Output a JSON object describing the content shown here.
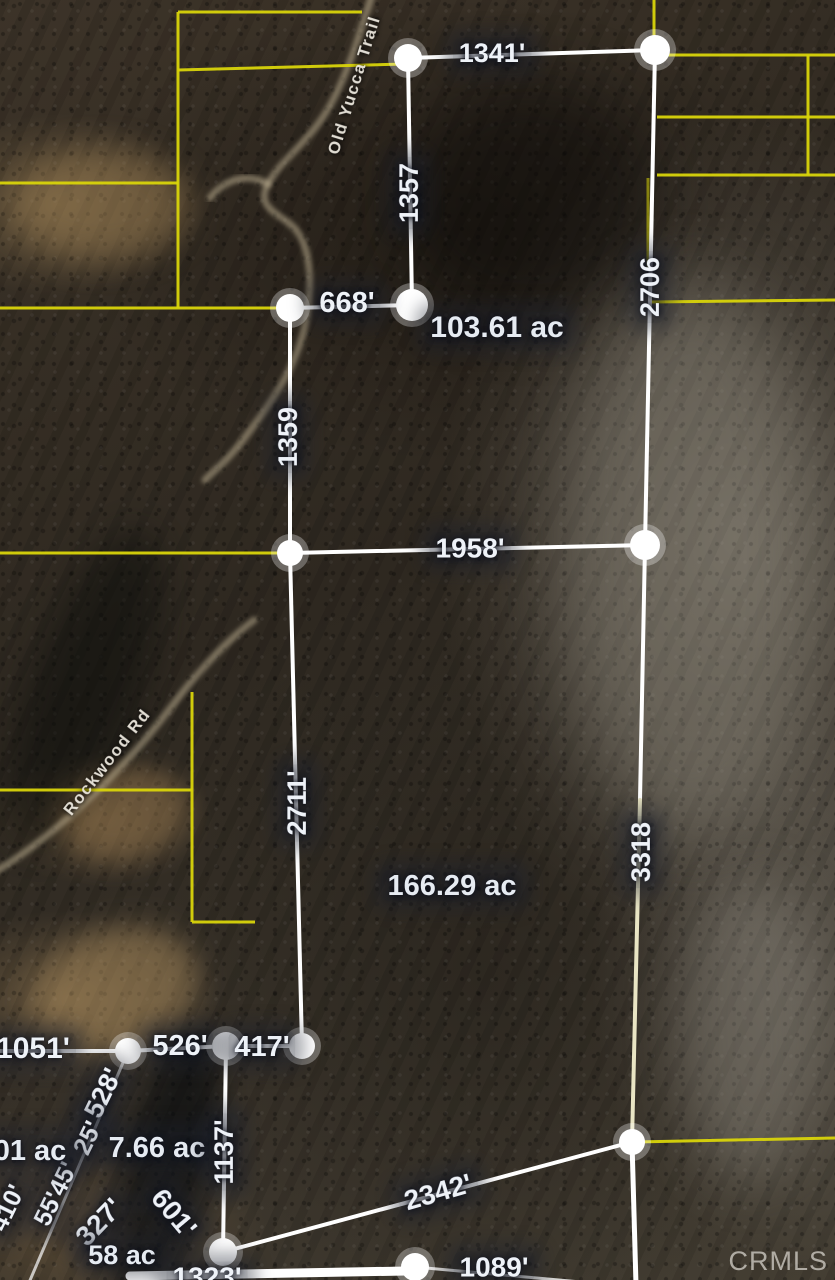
{
  "watermark": "CRMLS",
  "colors": {
    "boundary_white": "#ffffff",
    "boundary_cream": "#e9e5c4",
    "parcel_yellow": "#d9d40a",
    "label_text": "#eef2f8"
  },
  "parcels": [
    {
      "acreage_label": "103.61 ac",
      "side_labels": [
        "1341'",
        "1357",
        "668'",
        "1359",
        "1958'",
        "2706"
      ]
    },
    {
      "acreage_label": "166.29 ac",
      "side_labels": [
        "1958'",
        "2711'",
        "417'",
        "1137'",
        "2342'",
        "3318"
      ]
    }
  ],
  "roads_named": [
    "Old Yucca Trail",
    "Rockwood Rd"
  ],
  "overlay": {
    "labels": [
      {
        "name": "dim-1341",
        "text": "1341'",
        "x": 492,
        "y": 53,
        "rot": 0,
        "fs": 27,
        "cls": "dim"
      },
      {
        "name": "dim-1357",
        "text": "1357",
        "x": 409,
        "y": 193,
        "rot": -90,
        "fs": 27,
        "cls": "dim"
      },
      {
        "name": "dim-668",
        "text": "668'",
        "x": 347,
        "y": 303,
        "rot": 0,
        "fs": 29,
        "cls": "dim"
      },
      {
        "name": "acreage-103-61",
        "text": "103.61 ac",
        "x": 497,
        "y": 328,
        "rot": 0,
        "fs": 30,
        "cls": "ac"
      },
      {
        "name": "dim-2706",
        "text": "2706",
        "x": 650,
        "y": 287,
        "rot": -90,
        "fs": 27,
        "cls": "dim"
      },
      {
        "name": "dim-1359",
        "text": "1359",
        "x": 288,
        "y": 437,
        "rot": -90,
        "fs": 27,
        "cls": "dim"
      },
      {
        "name": "dim-1958",
        "text": "1958'",
        "x": 470,
        "y": 548,
        "rot": 0,
        "fs": 28,
        "cls": "dim"
      },
      {
        "name": "dim-2711",
        "text": "2711'",
        "x": 297,
        "y": 803,
        "rot": -90,
        "fs": 27,
        "cls": "dim"
      },
      {
        "name": "acreage-166-29",
        "text": "166.29 ac",
        "x": 452,
        "y": 886,
        "rot": 0,
        "fs": 29,
        "cls": "ac"
      },
      {
        "name": "dim-3318",
        "text": "3318",
        "x": 641,
        "y": 852,
        "rot": -90,
        "fs": 27,
        "cls": "dim"
      },
      {
        "name": "dim-1051",
        "text": "1051'",
        "x": 33,
        "y": 1049,
        "rot": 0,
        "fs": 30,
        "cls": "dim"
      },
      {
        "name": "dim-526",
        "text": "526'",
        "x": 180,
        "y": 1046,
        "rot": 0,
        "fs": 29,
        "cls": "dim"
      },
      {
        "name": "dim-417",
        "text": "417'",
        "x": 262,
        "y": 1047,
        "rot": 0,
        "fs": 29,
        "cls": "dim"
      },
      {
        "name": "dim-528",
        "text": "528'",
        "x": 103,
        "y": 1093,
        "rot": -64,
        "fs": 27,
        "cls": "dim"
      },
      {
        "name": "dim-25",
        "text": "25'",
        "x": 88,
        "y": 1138,
        "rot": -64,
        "fs": 25,
        "cls": "dim"
      },
      {
        "name": "dim-55-45",
        "text": "55'45'",
        "x": 56,
        "y": 1194,
        "rot": -64,
        "fs": 25,
        "cls": "dim"
      },
      {
        "name": "dim-410",
        "text": "410'",
        "x": 8,
        "y": 1208,
        "rot": -64,
        "fs": 25,
        "cls": "dim"
      },
      {
        "name": "acreage-01",
        "text": "01 ac",
        "x": 30,
        "y": 1151,
        "rot": 0,
        "fs": 29,
        "cls": "ac"
      },
      {
        "name": "acreage-7-66",
        "text": "7.66 ac",
        "x": 157,
        "y": 1148,
        "rot": 0,
        "fs": 29,
        "cls": "ac"
      },
      {
        "name": "dim-1137",
        "text": "1137'",
        "x": 224,
        "y": 1152,
        "rot": -90,
        "fs": 27,
        "cls": "dim"
      },
      {
        "name": "dim-327",
        "text": "327'",
        "x": 99,
        "y": 1222,
        "rot": -46,
        "fs": 28,
        "cls": "dim"
      },
      {
        "name": "dim-601",
        "text": "601'",
        "x": 174,
        "y": 1213,
        "rot": 50,
        "fs": 28,
        "cls": "dim"
      },
      {
        "name": "acreage-58",
        "text": "58 ac",
        "x": 122,
        "y": 1255,
        "rot": 0,
        "fs": 27,
        "cls": "ac"
      },
      {
        "name": "dim-1323",
        "text": "1323'",
        "x": 207,
        "y": 1277,
        "rot": 0,
        "fs": 28,
        "cls": "dim"
      },
      {
        "name": "dim-2342",
        "text": "2342'",
        "x": 438,
        "y": 1192,
        "rot": -16,
        "fs": 28,
        "cls": "dim"
      },
      {
        "name": "dim-1089",
        "text": "1089'",
        "x": 494,
        "y": 1267,
        "rot": 0,
        "fs": 28,
        "cls": "dim"
      },
      {
        "name": "road-old-yucca-trail",
        "text": "Old Yucca Trail",
        "x": 354,
        "y": 85,
        "rot": -73,
        "fs": 17,
        "cls": "road"
      },
      {
        "name": "road-rockwood-rd",
        "text": "Rockwood Rd",
        "x": 107,
        "y": 762,
        "rot": -52,
        "fs": 17,
        "cls": "road"
      }
    ],
    "white_lines": [
      {
        "x1": 408,
        "y1": 58,
        "x2": 655,
        "y2": 50
      },
      {
        "x1": 408,
        "y1": 58,
        "x2": 412,
        "y2": 305
      },
      {
        "x1": 290,
        "y1": 308,
        "x2": 412,
        "y2": 305
      },
      {
        "x1": 655,
        "y1": 50,
        "x2": 645,
        "y2": 545
      },
      {
        "x1": 290,
        "y1": 308,
        "x2": 290,
        "y2": 553
      },
      {
        "x1": 290,
        "y1": 553,
        "x2": 645,
        "y2": 545
      },
      {
        "x1": 290,
        "y1": 553,
        "x2": 302,
        "y2": 1046
      },
      {
        "x1": 645,
        "y1": 545,
        "x2": 640,
        "y2": 800
      },
      {
        "x1": 640,
        "y1": 800,
        "x2": 632,
        "y2": 1142,
        "c": "#e9e5c4"
      },
      {
        "x1": 302,
        "y1": 1046,
        "x2": 226,
        "y2": 1046
      },
      {
        "x1": 226,
        "y1": 1046,
        "x2": 128,
        "y2": 1051
      },
      {
        "x1": 128,
        "y1": 1051,
        "x2": -5,
        "y2": 1051
      },
      {
        "x1": 226,
        "y1": 1046,
        "x2": 223,
        "y2": 1252
      },
      {
        "x1": 223,
        "y1": 1252,
        "x2": 632,
        "y2": 1142
      },
      {
        "x1": 632,
        "y1": 1142,
        "x2": 636,
        "y2": 1285,
        "w": 5
      },
      {
        "x1": 130,
        "y1": 1276,
        "x2": 406,
        "y2": 1271,
        "w": 9
      },
      {
        "x1": 415,
        "y1": 1267,
        "x2": 625,
        "y2": 1286,
        "w": 3,
        "c": "rgba(255,255,255,0.8)"
      },
      {
        "x1": 128,
        "y1": 1051,
        "x2": 28,
        "y2": 1285,
        "w": 3,
        "c": "rgba(255,255,255,0.7)"
      }
    ],
    "yellow_lines": [
      {
        "x1": 178,
        "y1": 12,
        "x2": 178,
        "y2": 308
      },
      {
        "x1": 178,
        "y1": 12,
        "x2": 362,
        "y2": 12
      },
      {
        "x1": 178,
        "y1": 70,
        "x2": 405,
        "y2": 64
      },
      {
        "x1": 0,
        "y1": 183,
        "x2": 178,
        "y2": 183
      },
      {
        "x1": 0,
        "y1": 308,
        "x2": 290,
        "y2": 308
      },
      {
        "x1": 0,
        "y1": 553,
        "x2": 290,
        "y2": 553
      },
      {
        "x1": 192,
        "y1": 692,
        "x2": 192,
        "y2": 922
      },
      {
        "x1": 0,
        "y1": 790,
        "x2": 192,
        "y2": 790
      },
      {
        "x1": 192,
        "y1": 922,
        "x2": 255,
        "y2": 922
      },
      {
        "x1": 654,
        "y1": 0,
        "x2": 654,
        "y2": 50
      },
      {
        "x1": 655,
        "y1": 55,
        "x2": 835,
        "y2": 55
      },
      {
        "x1": 808,
        "y1": 55,
        "x2": 808,
        "y2": 175
      },
      {
        "x1": 657,
        "y1": 117,
        "x2": 835,
        "y2": 117
      },
      {
        "x1": 657,
        "y1": 175,
        "x2": 835,
        "y2": 175
      },
      {
        "x1": 650,
        "y1": 302,
        "x2": 835,
        "y2": 300
      },
      {
        "x1": 632,
        "y1": 1142,
        "x2": 835,
        "y2": 1138
      },
      {
        "x1": 648,
        "y1": 178,
        "x2": 648,
        "y2": 268,
        "o": 0.55
      }
    ],
    "nodes": [
      {
        "x": 408,
        "y": 58,
        "r": 14
      },
      {
        "x": 655,
        "y": 50,
        "r": 15
      },
      {
        "x": 412,
        "y": 305,
        "r": 16
      },
      {
        "x": 290,
        "y": 308,
        "r": 14
      },
      {
        "x": 645,
        "y": 545,
        "r": 15
      },
      {
        "x": 290,
        "y": 553,
        "r": 13
      },
      {
        "x": 302,
        "y": 1046,
        "r": 13
      },
      {
        "x": 226,
        "y": 1046,
        "r": 14
      },
      {
        "x": 128,
        "y": 1051,
        "r": 13
      },
      {
        "x": 223,
        "y": 1252,
        "r": 14
      },
      {
        "x": 632,
        "y": 1142,
        "r": 13
      },
      {
        "x": 415,
        "y": 1267,
        "r": 14
      }
    ],
    "roads": [
      {
        "name": "old-yucca-trail",
        "path": "M 372,-5 C 358,40 348,72 332,102 C 312,140 282,158 268,184 C 254,210 284,214 297,231 C 310,250 312,278 308,310 C 301,362 272,402 246,436 C 230,458 215,470 205,480"
      },
      {
        "name": "trail-spur",
        "path": "M 268,184 C 246,172 224,180 210,198"
      },
      {
        "name": "rockwood-rd",
        "path": "M -5,872 C 60,832 122,772 172,706 C 202,666 228,640 254,620"
      }
    ]
  }
}
